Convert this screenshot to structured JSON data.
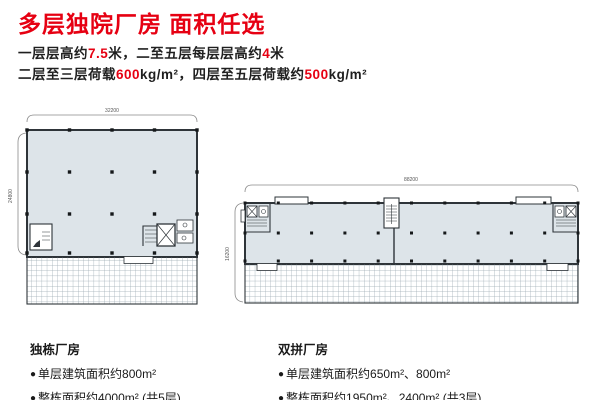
{
  "title": "多层独院厂房 面积任选",
  "specs": {
    "line1": [
      {
        "text": "一层层高约"
      },
      {
        "text": "7.5"
      },
      {
        "text": "米，二至五层每层层高约"
      },
      {
        "text": "4"
      },
      {
        "text": "米"
      }
    ],
    "line2": [
      {
        "text": "二层至三层荷载"
      },
      {
        "text": "600"
      },
      {
        "text": "kg/m²，四层至五层荷载约"
      },
      {
        "text": "500"
      },
      {
        "text": "kg/m²"
      }
    ]
  },
  "plans": {
    "left": {
      "width_dim": "32200",
      "depth_dim": "24800"
    },
    "right": {
      "width_dim": "88200",
      "depth_dim": "16200"
    }
  },
  "sections": {
    "detached": {
      "heading": "独栋厂房",
      "marker": "●",
      "bullets": [
        "单层建筑面积约800m²",
        "整栋面积约4000m² (共5层)"
      ]
    },
    "duplex": {
      "heading": "双拼厂房",
      "marker": "●",
      "bullets": [
        "单层建筑面积约650m²、800m²",
        "整栋面积约1950m²、2400m² (共3层)"
      ]
    }
  },
  "colors": {
    "accent": "#e60012",
    "text": "#1f1f1f",
    "plan_fill": "#dde4e9",
    "plan_stroke": "#2e3439",
    "hatch_line": "#9aa9b1",
    "dim_line": "#8a8a8a"
  }
}
